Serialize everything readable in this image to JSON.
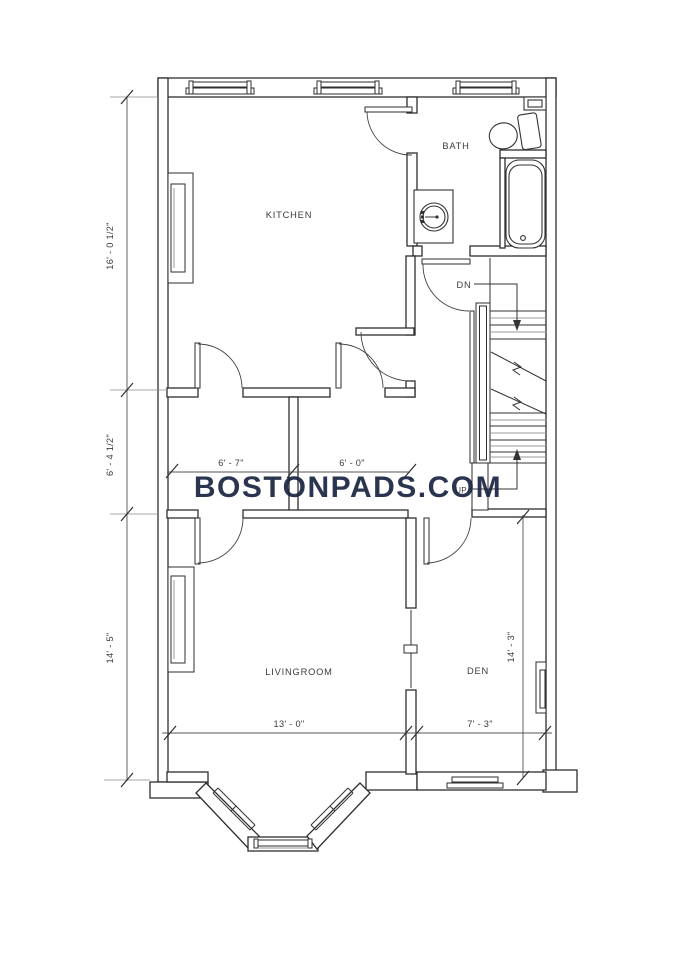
{
  "watermark": {
    "text": "BOSTONPADS.COM",
    "color": "#1a2441"
  },
  "rooms": {
    "kitchen": "KITCHEN",
    "bath": "BATH",
    "livingroom": "LIVINGROOM",
    "den": "DEN"
  },
  "stairs": {
    "down_label": "DN",
    "up_label": "UP"
  },
  "dimensions": {
    "left_top": "16' - 0 1/2\"",
    "left_middle": "6' - 4 1/2\"",
    "left_bottom": "14' - 5\"",
    "hall_left": "6' - 7\"",
    "hall_right": "6' - 0\"",
    "living_width": "13' - 0\"",
    "den_width": "7' - 3\"",
    "den_height": "14' - 3\""
  },
  "colors": {
    "wall": "#2e2e2e",
    "dimension": "#555555",
    "extension": "#8a8a8a",
    "watermark": "#1a2441",
    "background": "#ffffff"
  }
}
